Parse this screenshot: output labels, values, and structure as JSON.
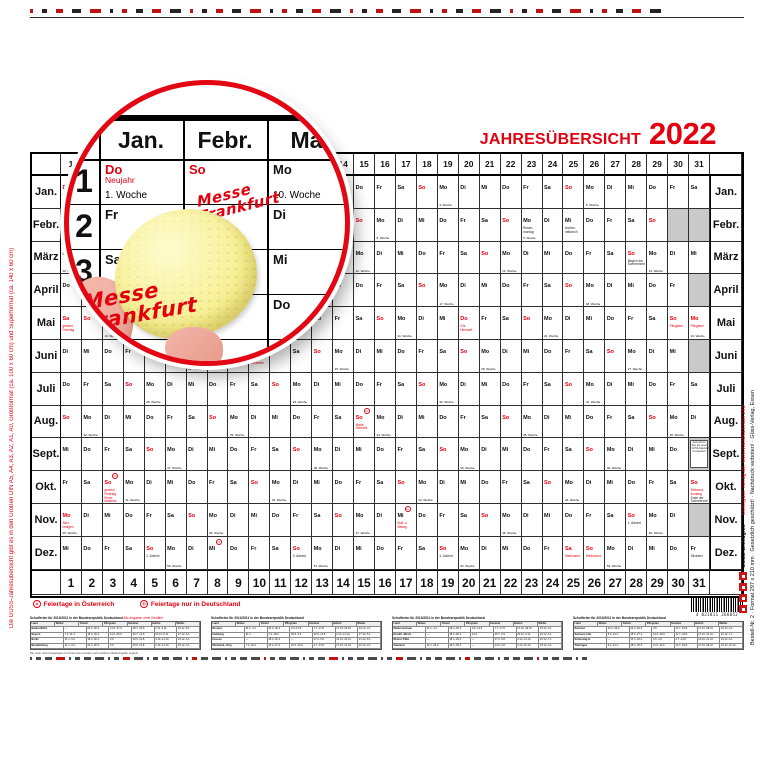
{
  "title": {
    "text": "JAHRESÜBERSICHT",
    "year": "2022",
    "color": "#e3000f"
  },
  "calendar": {
    "weekdays": [
      "Mo",
      "Di",
      "Mi",
      "Do",
      "Fr",
      "Sa",
      "So"
    ],
    "months": [
      {
        "label": "Jan.",
        "start": 3,
        "days": 31
      },
      {
        "label": "Febr.",
        "start": 6,
        "days": 29
      },
      {
        "label": "März",
        "start": 0,
        "days": 31
      },
      {
        "label": "April",
        "start": 3,
        "days": 30
      },
      {
        "label": "Mai",
        "start": 5,
        "days": 31
      },
      {
        "label": "Juni",
        "start": 1,
        "days": 30
      },
      {
        "label": "Juli",
        "start": 3,
        "days": 31
      },
      {
        "label": "Aug.",
        "start": 6,
        "days": 31
      },
      {
        "label": "Sept.",
        "start": 2,
        "days": 30
      },
      {
        "label": "Okt.",
        "start": 4,
        "days": 31
      },
      {
        "label": "Nov.",
        "start": 0,
        "days": 30
      },
      {
        "label": "Dez.",
        "start": 2,
        "days": 31
      }
    ],
    "weeks": {
      "0-1": "1. Woche",
      "0-5": "2. Woche",
      "0-12": "3. Woche",
      "0-19": "4. Woche",
      "0-26": "5. Woche",
      "1-2": "6. Woche",
      "1-9": "7. Woche",
      "1-16": "8. Woche",
      "1-23": "9. Woche",
      "2-1": "10. Woche",
      "2-8": "11. Woche",
      "2-15": "12. Woche",
      "2-22": "13. Woche",
      "2-29": "14. Woche",
      "3-5": "15. Woche",
      "3-12": "16. Woche",
      "3-19": "17. Woche",
      "3-26": "18. Woche",
      "4-3": "19. Woche",
      "4-10": "20. Woche",
      "4-17": "21. Woche",
      "4-24": "22. Woche",
      "4-31": "23. Woche",
      "5-7": "24. Woche",
      "5-14": "25. Woche",
      "5-21": "26. Woche",
      "5-28": "27. Woche",
      "6-5": "28. Woche",
      "6-12": "29. Woche",
      "6-19": "30. Woche",
      "6-26": "31. Woche",
      "7-2": "32. Woche",
      "7-9": "33. Woche",
      "7-16": "34. Woche",
      "7-23": "35. Woche",
      "7-30": "36. Woche",
      "8-6": "37. Woche",
      "8-13": "38. Woche",
      "8-20": "39. Woche",
      "8-27": "40. Woche",
      "9-4": "41. Woche",
      "9-11": "42. Woche",
      "9-18": "43. Woche",
      "9-25": "44. Woche",
      "10-1": "45. Woche",
      "10-8": "46. Woche",
      "10-15": "47. Woche",
      "10-22": "48. Woche",
      "10-29": "49. Woche",
      "11-6": "50. Woche",
      "11-13": "51. Woche",
      "11-20": "52. Woche",
      "11-27": "53. Woche"
    },
    "notes": {
      "0-1": {
        "t": [
          "Neujahr"
        ],
        "c": "r",
        "wr": 1
      },
      "1-23": {
        "t": [
          "Rosen-",
          "montag"
        ],
        "c": "b"
      },
      "1-25": {
        "t": [
          "Ascher-",
          "mittwoch"
        ],
        "c": "b"
      },
      "2-28": {
        "t": [
          "Beginn der",
          "Sommerzeit"
        ],
        "c": "b"
      },
      "3-9": {
        "t": [
          "Karfreitag"
        ],
        "c": "r",
        "wr": 1
      },
      "3-11": {
        "t": [
          "Ostern"
        ],
        "c": "r"
      },
      "3-12": {
        "t": [
          "Oster-",
          "montag"
        ],
        "c": "r",
        "wr": 1
      },
      "4-1": {
        "t": [
          "gesetzl.",
          "Feiertag"
        ],
        "c": "r",
        "wr": 1
      },
      "4-20": {
        "t": [
          "Chr.",
          "Himmelf."
        ],
        "c": "r",
        "wr": 1
      },
      "4-30": {
        "t": [
          "Pfingsten"
        ],
        "c": "r"
      },
      "4-31": {
        "t": [
          "Pfingsten"
        ],
        "c": "r",
        "wr": 1
      },
      "5-10": {
        "t": [
          "Fron-",
          "leichnam"
        ],
        "c": "r",
        "wr": 1
      },
      "7-15": {
        "t": [
          "Mariä",
          "Himmelf."
        ],
        "c": "r",
        "m": "A"
      },
      "9-3": {
        "t": [
          "gesetzl.",
          "Feiertag",
          "Ernte-",
          "dankfest"
        ],
        "c": "r",
        "m": "D"
      },
      "9-31": {
        "t": [
          "Reforma-",
          "tionstag"
        ],
        "c": "r",
        "t2": [
          "Ende der",
          "Sommerzeit"
        ]
      },
      "10-1": {
        "t": [
          "Aller-",
          "heiligen"
        ],
        "c": "r",
        "wr": 1
      },
      "10-17": {
        "t": [
          "Buß- u.",
          "Bettag"
        ],
        "c": "r",
        "m": "D"
      },
      "10-28": {
        "t": [
          "1. Advent"
        ],
        "c": "b"
      },
      "11-5": {
        "t": [
          "2. Advent"
        ],
        "c": "b"
      },
      "11-8": {
        "c": "r",
        "m": "A"
      },
      "11-12": {
        "t": [
          "3. Advent"
        ],
        "c": "b"
      },
      "11-19": {
        "t": [
          "4. Advent"
        ],
        "c": "b"
      },
      "11-25": {
        "t": [
          "Weihnacht."
        ],
        "c": "r",
        "wr": 1
      },
      "11-26": {
        "t": [
          "Weihnacht."
        ],
        "c": "r"
      },
      "11-31": {
        "t": [
          "Silvester"
        ],
        "c": "b"
      }
    },
    "invalid": {
      "1": [
        30,
        31
      ],
      "3": [
        31
      ],
      "5": [
        31
      ],
      "8": [
        31
      ],
      "10": [
        31
      ]
    },
    "promo": {
      "month": 8,
      "day": 31,
      "lines": [
        "Jetzt wird es",
        "Zeit, die neuen",
        "GÜSS-Kalender",
        "zu bestellen!"
      ]
    }
  },
  "legend": [
    {
      "symbol": "A",
      "label": "Feiertage in Österreich"
    },
    {
      "symbol": "D",
      "label": "Feiertage nur in Deutschland"
    }
  ],
  "magnifier": {
    "months": [
      "Jan.",
      "Febr.",
      "Mär"
    ],
    "rows": [
      {
        "num": "1",
        "cells": [
          {
            "wd": "Do",
            "red": 1,
            "note": "Neujahr",
            "week": "1. Woche"
          },
          {
            "wd": "So",
            "red": 1
          },
          {
            "wd": "Mo",
            "week": "10. Woche"
          }
        ]
      },
      {
        "num": "2",
        "cells": [
          {
            "wd": "Fr"
          },
          {
            "wd": "Mo",
            "week": "6. Woche"
          },
          {
            "wd": "Di"
          }
        ]
      },
      {
        "num": "3",
        "cells": [
          {
            "wd": "Sa"
          },
          {
            "wd": "Di"
          },
          {
            "wd": "Mi"
          }
        ]
      },
      {
        "num": "4",
        "cells": [
          {
            "wd": "So",
            "red": 1
          },
          {
            "wd": "Mi"
          },
          {
            "wd": "Do"
          }
        ]
      },
      {
        "num": "5",
        "cells": [
          {
            "wd": "Mo"
          },
          {
            "wd": "Do"
          },
          {
            "wd": "Fr"
          }
        ]
      }
    ],
    "scribbles": [
      {
        "lines": [
          "Messe",
          "Frankfurt"
        ],
        "x": 128,
        "y": 100,
        "size": 15,
        "rot": -14
      },
      {
        "lines": [
          "Messe",
          "Frankfurt"
        ],
        "x": 14,
        "y": 198,
        "size": 21,
        "rot": -10
      }
    ]
  },
  "footer": {
    "blocks": [
      {
        "title": "Schulferien für 2010/2011 in der Bundesrepublik Deutschland",
        "note": "Alle Angaben ohne Gewähr!",
        "columns": [
          "Land",
          "Winter",
          "Ostern",
          "Pfingsten",
          "Sommer",
          "Herbst",
          "Weihn."
        ],
        "rows": [
          {
            "land": "Baden-Württ.",
            "cells": [
              "—",
              "22.4.-30.4.",
              "14.6.-17.6.",
              "28.7.-10.9.",
              "2.11.-6.11.",
              "23.12.-8.1."
            ]
          },
          {
            "land": "Bayern",
            "cells": [
              "7.3.-11.3.",
              "18.4.-30.4.",
              "14.6.-25.6.",
              "30.7.-12.9.",
              "31.10.-5.11.",
              "27.12.-5.1."
            ]
          },
          {
            "land": "Berlin",
            "cells": [
              "31.1.-5.2.",
              "18.4.-30.4.",
              "3.6.",
              "29.6.-12.8.",
              "4.10.-14.10.",
              "23.12.-3.1."
            ]
          },
          {
            "land": "Brandenburg",
            "cells": [
              "31.1.-5.2.",
              "20.4.-30.4.",
              "3.6.",
              "29.6.-12.8.",
              "4.10.-14.10.",
              "23.12.-3.1."
            ]
          }
        ]
      },
      {
        "title": "Schulferien für 2010/2011 in der Bundesrepublik Deutschland",
        "note": "",
        "columns": [
          "Land",
          "Winter",
          "Ostern",
          "Pfingsten",
          "Sommer",
          "Herbst",
          "Weihn."
        ],
        "rows": [
          {
            "land": "Bremen",
            "cells": [
              "31.1.-1.2.",
              "16.4.-30.4.",
              "3.6.-14.6.",
              "7.7.-17.8.",
              "17.10.-29.10.",
              "23.12.-4.1."
            ]
          },
          {
            "land": "Hamburg",
            "cells": [
              "31.1.",
              "7.3.-18.3.",
              "30.5.-3.6.",
              "30.6.-10.8.",
              "4.10.-14.10.",
              "27.12.-6.1."
            ]
          },
          {
            "land": "Hessen",
            "cells": [
              "—",
              "18.4.-30.4.",
              "—",
              "27.6.-5.8.",
              "10.10.-22.10.",
              "21.12.-6.1."
            ]
          },
          {
            "land": "Mecklenb.-Vorp.",
            "cells": [
              "7.2.-19.2.",
              "16.4.-27.4.",
              "10.6.-14.6.",
              "4.7.-13.8.",
              "17.10.-21.10.",
              "23.12.-3.1."
            ]
          }
        ]
      },
      {
        "title": "Schulferien für 2010/2011 in der Bundesrepublik Deutschland",
        "note": "",
        "columns": [
          "Land",
          "Winter",
          "Ostern",
          "Pfingsten",
          "Sommer",
          "Herbst",
          "Weihn."
        ],
        "rows": [
          {
            "land": "Niedersachsen",
            "cells": [
              "31.1.-1.2.",
              "16.4.-30.4.",
              "3.6.-14.6.",
              "7.7.-17.8.",
              "17.10.-29.10.",
              "23.12.-4.1."
            ]
          },
          {
            "land": "Nordrh.-Westf.",
            "cells": [
              "—",
              "18.4.-30.4.",
              "14.6.",
              "25.7.-6.9.",
              "24.10.-5.11.",
              "23.12.-6.1."
            ]
          },
          {
            "land": "Rheinl.-Pfalz",
            "cells": [
              "—",
              "18.4.-29.4.",
              "—",
              "27.6.-5.8.",
              "4.10.-14.10.",
              "22.12.-7.1."
            ]
          },
          {
            "land": "Saarland",
            "cells": [
              "21.2.-26.2.",
              "18.4.-30.4.",
              "—",
              "24.6.-6.8.",
              "4.10.-15.10.",
              "23.12.-4.1."
            ]
          }
        ]
      },
      {
        "title": "Schulferien für 2010/2011 in der Bundesrepublik Deutschland",
        "note": "",
        "columns": [
          "Land",
          "Winter",
          "Ostern",
          "Pfingsten",
          "Sommer",
          "Herbst",
          "Weihn."
        ],
        "rows": [
          {
            "land": "Sachsen",
            "cells": [
              "12.2.-26.2.",
              "22.4.-30.4.",
              "3.6.",
              "11.7.-19.8.",
              "17.10.-28.10.",
              "23.12.-2.1."
            ]
          },
          {
            "land": "Sachsen-Anh.",
            "cells": [
              "5.2.-12.2.",
              "18.4.-27.4.",
              "14.6.-18.6.",
              "11.7.-24.8.",
              "17.10.-21.10.",
              "22.12.-7.1."
            ]
          },
          {
            "land": "Schleswig-H.",
            "cells": [
              "—",
              "15.4.-30.4.",
              "3.6.-4.6.",
              "4.7.-13.8.",
              "10.10.-21.10.",
              "23.12.-6.1."
            ]
          },
          {
            "land": "Thüringen",
            "cells": [
              "5.2.-12.2.",
              "18.4.-30.4.",
              "11.6.-14.6.",
              "11.7.-19.8.",
              "17.10.-28.10.",
              "23.12.-31.12."
            ]
          }
        ]
      }
    ],
    "footnote": "Die noch nicht festgelegten Ferientermine werden nach amtlicher Bekanntgabe ergänzt."
  },
  "barcode": {
    "digits": "4 021811 266052"
  },
  "side_texts": {
    "left_red": "Die GÜSS-Jahresübersicht gibt es in den Größen DIN A5, A4, A3, A2, A1, A0, Großformat (ca. 100 x 60 cm) und Superformat (ca. 140 x 60 cm)",
    "right_red": "www.güss-verlag.de, www.wandkalender.info",
    "right_black": "Bestell-Nr. 2 · Format 297 x 210 mm · Gesetzlich geschützt! · Nachdruck verboten! · Güss-Verlag, Essen",
    "erzeugnis": "GÜSS-Erzeugnis"
  },
  "decor": {
    "top_marks": 40,
    "bottom_marks": 58
  }
}
